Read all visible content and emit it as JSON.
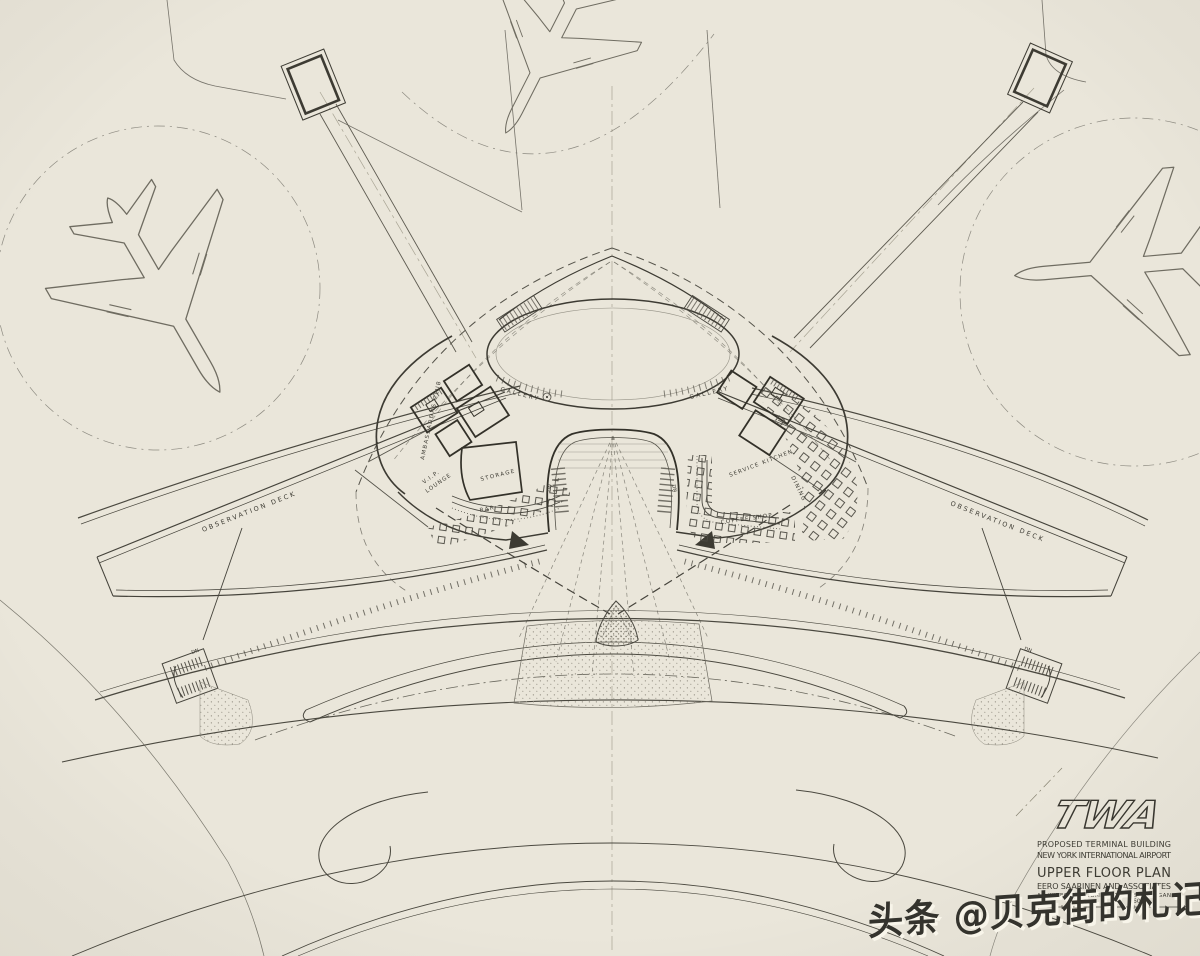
{
  "colors": {
    "paper": "#eae6da",
    "ink": "#3d3b33",
    "ink_light": "#6f6c61",
    "watermark_text": "#34332d",
    "watermark_shadow": "#f8f5ea"
  },
  "title_block": {
    "logo": "TWA",
    "project_line1": "PROPOSED TERMINAL BUILDING",
    "project_line2": "NEW YORK INTERNATIONAL AIRPORT",
    "sheet_title": "UPPER FLOOR PLAN",
    "firm_line1": "EERO SAARINEN AND ASSOCIATES",
    "firm_line2": "ARCHITECTS   BLOOMFIELD HILLS   MICHIGAN",
    "scale_mark": "60'"
  },
  "plan_labels": {
    "gallery_left": "GALLERY",
    "gallery_right": "GALLERY",
    "ambassadors_club": "AMBASSADORS CLUB",
    "vip_lounge_line1": "V.I.P.",
    "vip_lounge_line2": "LOUNGE",
    "storage": "STORAGE",
    "bar": "BAR",
    "service_kitchen": "SERVICE KITCHEN",
    "dining": "DINING",
    "coffee_shop": "COFFEE SHOP",
    "observation_deck_left": "OBSERVATION DECK",
    "observation_deck_right": "OBSERVATION DECK",
    "down_arch_left": "DN",
    "down_arch_right": "DN",
    "down_wing_left": "DN",
    "down_wing_right": "DN"
  },
  "watermark": {
    "text": "头条 @贝克街的札记"
  }
}
